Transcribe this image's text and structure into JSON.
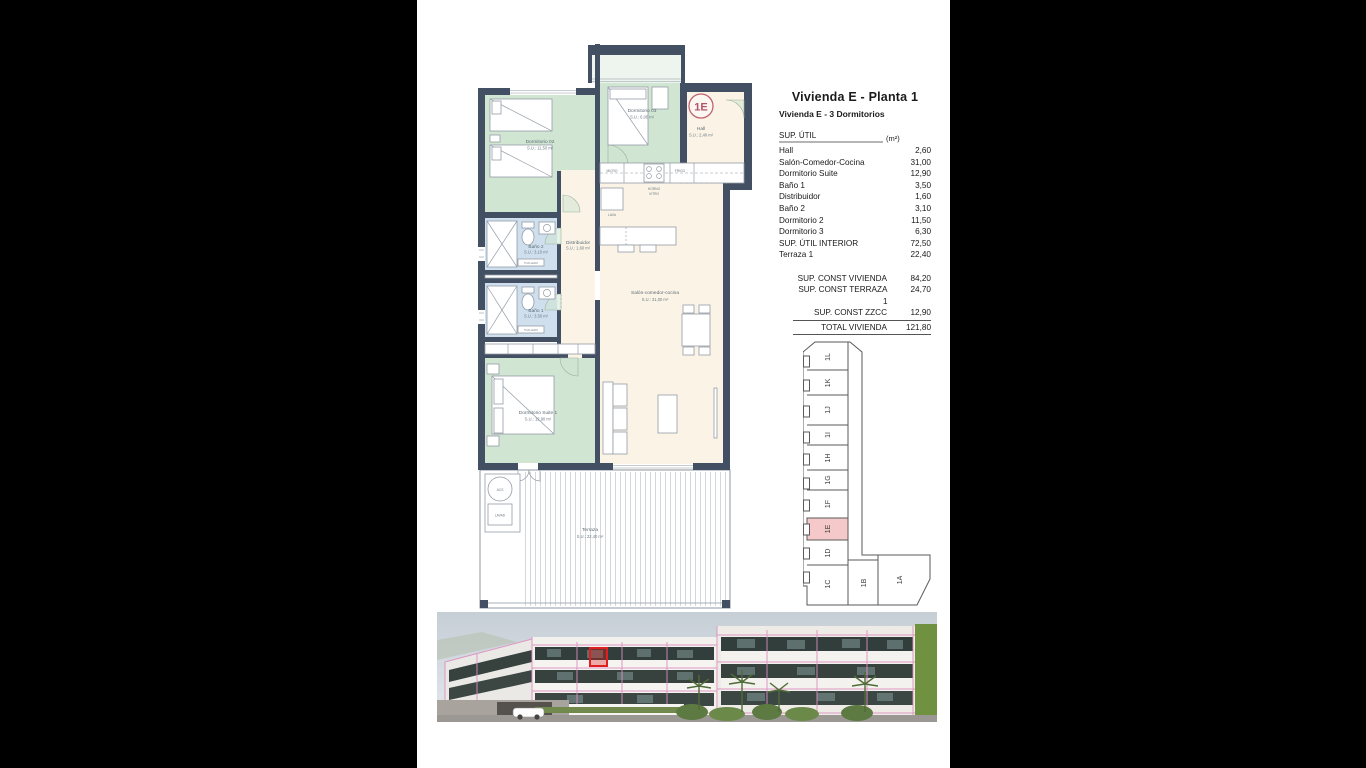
{
  "page": {
    "title": "Vivienda E - Planta 1",
    "subtitle": "Vivienda E - 3 Dormitorios"
  },
  "area_table": {
    "header": {
      "label": "SUP. ÚTIL",
      "unit": "(m²)"
    },
    "rows": [
      {
        "label": "Hall",
        "value": "2,60"
      },
      {
        "label": "Salón-Comedor-Cocina",
        "value": "31,00"
      },
      {
        "label": "Dormitorio Suite",
        "value": "12,90"
      },
      {
        "label": "Baño 1",
        "value": "3,50"
      },
      {
        "label": "Distribuidor",
        "value": "1,60"
      },
      {
        "label": "Baño 2",
        "value": "3,10"
      },
      {
        "label": "Dormitorio 2",
        "value": "11,50"
      },
      {
        "label": "Dormitorio 3",
        "value": "6,30"
      },
      {
        "label": "SUP. ÚTIL INTERIOR",
        "value": "72,50"
      },
      {
        "label": "Terraza 1",
        "value": "22,40"
      }
    ],
    "summary": [
      {
        "label": "SUP. CONST VIVIENDA",
        "value": "84,20"
      },
      {
        "label": "SUP. CONST TERRAZA 1",
        "value": "24,70"
      },
      {
        "label": "SUP. CONST ZZCC",
        "value": "12,90"
      }
    ],
    "total": {
      "label": "TOTAL VIVIENDA",
      "value": "121,80"
    }
  },
  "floorplan": {
    "unit_badge": "1E",
    "rooms": {
      "dormitorio02": {
        "name": "Dormitorio 02",
        "area": "S.U.: 11,50 m²"
      },
      "dormitorio03": {
        "name": "Dormitorio 03",
        "area": "S.U.: 6,00 m²"
      },
      "hall": {
        "name": "Hall",
        "area": "S.U.: 2,40 m²"
      },
      "bano2": {
        "name": "Baño 2",
        "area": "S.U.: 3,10 m²"
      },
      "distribuidor": {
        "name": "Distribuidor",
        "area": "S.U.: 1,60 m²"
      },
      "bano1": {
        "name": "Baño 1",
        "area": "S.U.: 3,50 m²"
      },
      "salon": {
        "name": "Salón-comedor-cocina",
        "area": "S.U.: 31,00 m²"
      },
      "suite": {
        "name": "Dormitorio Suite 1",
        "area": "S.U.: 12,90 m²"
      },
      "terraza": {
        "name": "Terraza",
        "area": "S.U.: 22,40 m²"
      }
    },
    "labels": {
      "micro": "MICRO",
      "frigo": "FRIGO",
      "horno": "HORNO",
      "vitro": "VITRO",
      "lava": "LAVA",
      "acs": "ACS",
      "lavad": "LAVAD",
      "toallero": "TOALLERO"
    }
  },
  "keyplan": {
    "units": [
      "1L",
      "1K",
      "1J",
      "1I",
      "1H",
      "1G",
      "1F",
      "1E",
      "1D",
      "1C",
      "1B",
      "1A"
    ],
    "highlighted_unit": "1E"
  },
  "colors": {
    "wall": "#434f62",
    "room_green": "#d0e5d2",
    "room_cream": "#fbf4e6",
    "room_blue": "#cfdfee",
    "badge_red": "#b4536a",
    "keyplan_highlight": "#f5c9c9",
    "render_grid_pink": "#dc8fc0",
    "render_highlight_red": "#e02020"
  }
}
